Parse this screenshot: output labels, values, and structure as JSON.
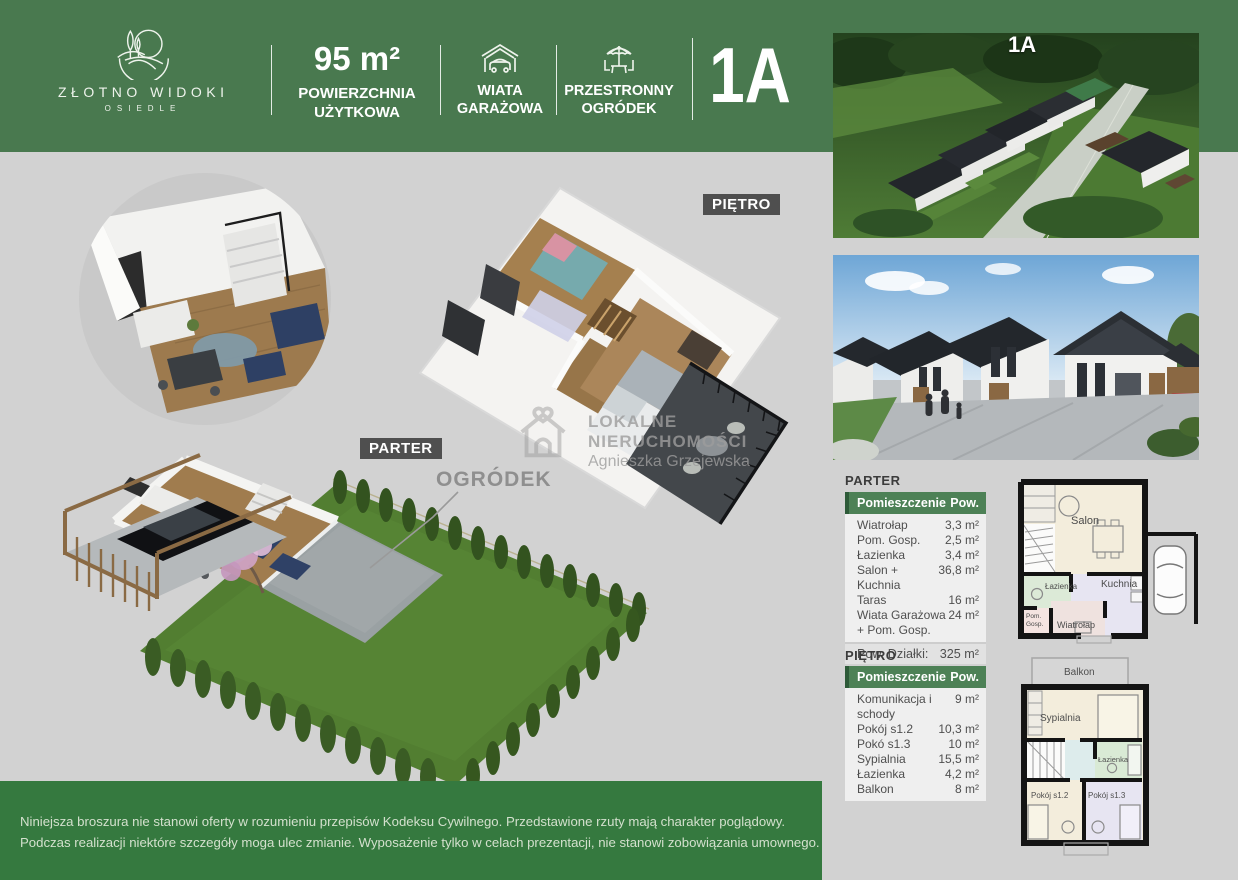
{
  "header": {
    "logo": {
      "title": "ZŁOTNO WIDOKI",
      "subtitle": "OSIEDLE"
    },
    "area": {
      "value": "95 m²",
      "label_line1": "POWIERZCHNIA",
      "label_line2": "UŻYTKOWA"
    },
    "feature_garage": {
      "line1": "WIATA",
      "line2": "GARAŻOWA"
    },
    "feature_garden": {
      "line1": "PRZESTRONNY",
      "line2": "OGRÓDEK"
    },
    "unit": "1A"
  },
  "photos": {
    "aerial_badge": "1A"
  },
  "plan_labels": {
    "pietro": "PIĘTRO",
    "parter": "PARTER",
    "ogrodek": "OGRÓDEK"
  },
  "watermark": {
    "line1": "LOKALNE",
    "line2": "NIERUCHOMOŚCI",
    "line3": "Agnieszka Grzejewska"
  },
  "tables": {
    "parter": {
      "title": "PARTER",
      "col_room": "Pomieszczenie",
      "col_area": "Pow.",
      "rows": [
        {
          "room": "Wiatrołap",
          "area": "3,3 m²"
        },
        {
          "room": "Pom. Gosp.",
          "area": "2,5 m²"
        },
        {
          "room": "Łazienka",
          "area": "3,4 m²"
        },
        {
          "room": "Salon + Kuchnia",
          "area": "36,8 m²"
        },
        {
          "room": "Taras",
          "area": "16 m²"
        },
        {
          "room": "Wiata Garażowa + Pom. Gosp.",
          "area": "24 m²"
        }
      ],
      "summary": {
        "room": "Pow. Działki:",
        "area": "325 m²"
      }
    },
    "pietro": {
      "title": "PIĘTRO",
      "col_room": "Pomieszczenie",
      "col_area": "Pow.",
      "rows": [
        {
          "room": "Komunikacja i schody",
          "area": "9 m²"
        },
        {
          "room": "Pokój s1.2",
          "area": "10,3 m²"
        },
        {
          "room": "Pokó s1.3",
          "area": "10 m²"
        },
        {
          "room": "Sypialnia",
          "area": "15,5 m²"
        },
        {
          "room": "Łazienka",
          "area": "4,2 m²"
        },
        {
          "room": "Balkon",
          "area": "8 m²"
        }
      ]
    }
  },
  "plan2d": {
    "parter": {
      "salon": "Salon",
      "lazienka": "Łazienka",
      "kuchnia": "Kuchnia",
      "pom": "Pom.",
      "gosp": "Gosp.",
      "wiatrolap": "Wiatrołap"
    },
    "pietro": {
      "balkon": "Balkon",
      "sypialnia": "Sypialnia",
      "lazienka": "Łazienka",
      "pokoj12": "Pokój s1.2",
      "pokoj13": "Pokój s1.3"
    }
  },
  "footer": {
    "line1": "Niniejsza broszura nie stanowi oferty w rozumieniu przepisów Kodeksu Cywilnego. Przedstawione rzuty mają charakter poglądowy.",
    "line2": "Podczas realizacji niektóre szczegóły moga ulec zmianie. Wyposażenie tylko w celach prezentacji, nie stanowi zobowiązania umownego."
  },
  "colors": {
    "header_green": "#49794f",
    "footer_green": "#35793f",
    "table_header_green": "#4d8156",
    "background_gray": "#d2d2d2",
    "badge_gray": "#4f4f4f"
  }
}
